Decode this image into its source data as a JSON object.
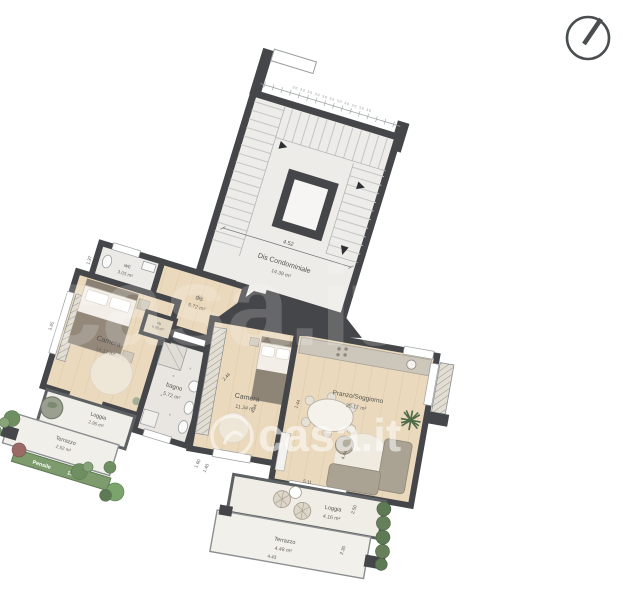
{
  "watermark": {
    "brand": "casa.it"
  },
  "stair": {
    "dim_top_chain": "30 30 30 30 30 30 30 30 30 30 30",
    "dim_width": "4.52",
    "room_label": "Dis Condominiale",
    "room_area": "14.39 m²"
  },
  "rooms": {
    "wc": {
      "label": "wc",
      "area": "3.03 m²"
    },
    "dis": {
      "label": "dis",
      "area": "5.72 m²"
    },
    "camera1": {
      "label": "Camera",
      "area": "14.17 m²"
    },
    "bagno": {
      "label": "bagno",
      "area": "5.72 m²"
    },
    "rip": {
      "label": "rip",
      "area": "0.93 m²"
    },
    "camera2": {
      "label": "Camera",
      "area": "11.34 m²"
    },
    "soggiorno": {
      "label": "Pranzo/Soggiorno",
      "area": "25.17 m²"
    },
    "loggia1": {
      "label": "Loggia",
      "area": "2.95 m²"
    },
    "terrazzo1": {
      "label": "Terrazzo",
      "area": "2.52 m²"
    },
    "pensile": {
      "label": "Pensile",
      "area": "1.32 m²"
    },
    "loggia2": {
      "label": "Loggia",
      "area": "4.16 m²"
    },
    "terrazzo2": {
      "label": "Terrazzo",
      "area": "4.48 m²"
    }
  },
  "dims": {
    "wc_w": "2.41",
    "wc_h": "1.37",
    "camera1_h": "3.85",
    "bagno_h": "3.72",
    "camera2_top": "2.44",
    "camera2_side": "4.34",
    "divider": "4.44",
    "sogg_side": "1.44",
    "loggia2_w": "5.11",
    "loggia2_h": "2.50",
    "terrazzo2_w": "4.43",
    "terrazzo2_h": "2.30",
    "win_a": "1.60",
    "win_b": "1.40"
  }
}
